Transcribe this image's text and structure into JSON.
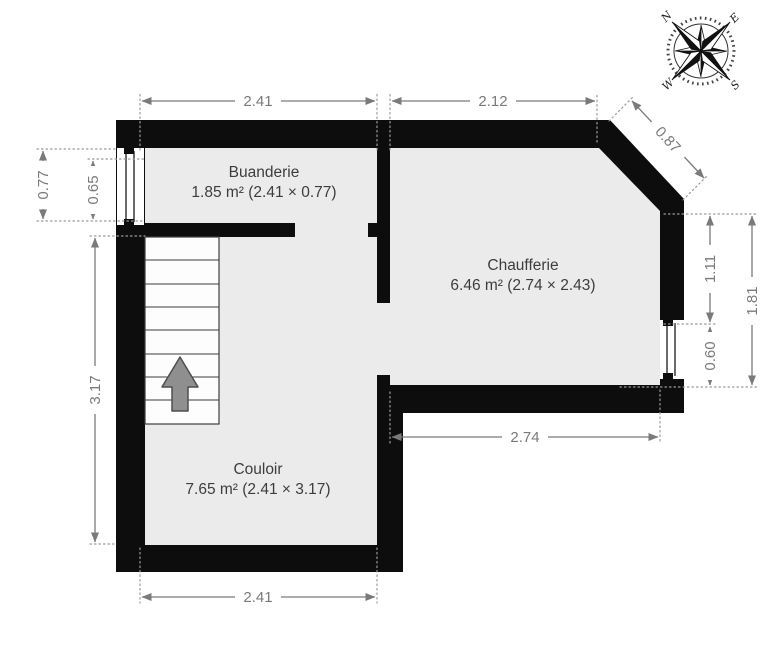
{
  "colors": {
    "wall": "#0d0d0d",
    "room_fill": "#ebebeb",
    "dimension": "#7a7a7a",
    "room_text": "#3d3d3d",
    "arrow_fill": "#8f8f8f"
  },
  "rooms": [
    {
      "id": "buanderie",
      "name": "Buanderie",
      "area": "1.85 m² (2.41 × 0.77)"
    },
    {
      "id": "chaufferie",
      "name": "Chaufferie",
      "area": "6.46 m² (2.74 × 2.43)"
    },
    {
      "id": "couloir",
      "name": "Couloir",
      "area": "7.65 m² (2.41 × 3.17)"
    }
  ],
  "dimensions": {
    "top_buanderie": "2.41",
    "top_chaufferie": "2.12",
    "chamfer": "0.87",
    "left_window_outer": "0.77",
    "left_window_inner": "0.65",
    "right_upper": "1.11",
    "right_window": "0.60",
    "right_total": "1.81",
    "chaufferie_width": "2.74",
    "couloir_height": "3.17",
    "couloir_width": "2.41"
  },
  "compass": {
    "n": "N",
    "e": "E",
    "s": "S",
    "w": "W"
  }
}
